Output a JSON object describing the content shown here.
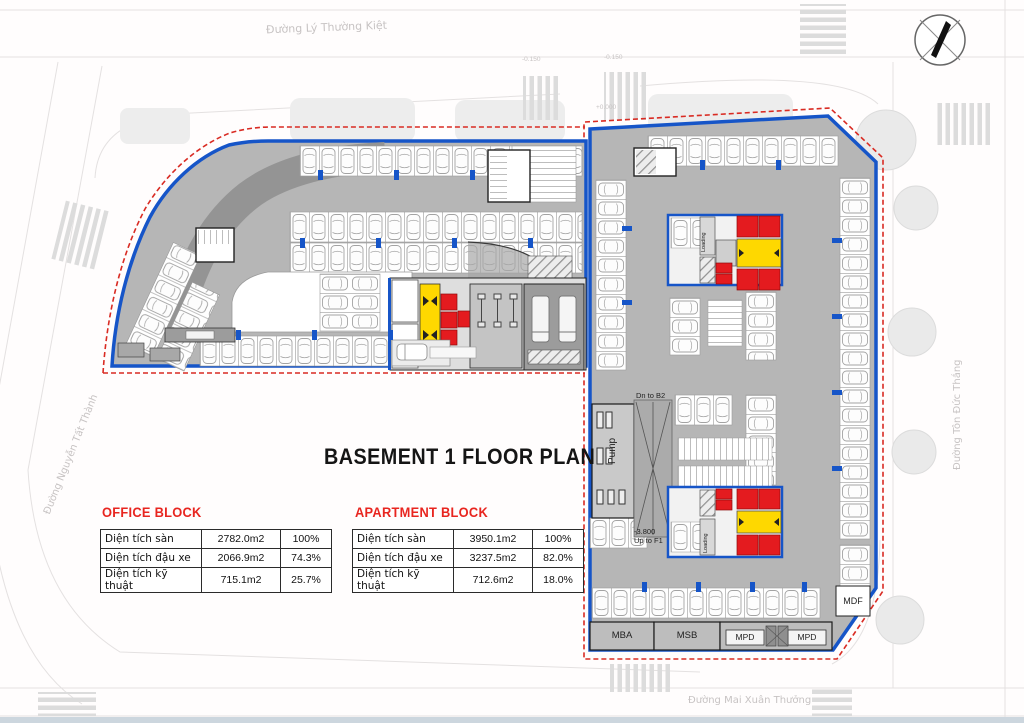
{
  "title": "BASEMENT 1 FLOOR PLAN",
  "tables": {
    "office": {
      "header": "OFFICE BLOCK",
      "rows": [
        {
          "label": "Diện tích sàn",
          "value": "2782.0m2",
          "percent": "100%"
        },
        {
          "label": "Diện tích đậu xe",
          "value": "2066.9m2",
          "percent": "74.3%"
        },
        {
          "label": "Diện tích kỹ thuật",
          "value": "715.1m2",
          "percent": "25.7%"
        }
      ]
    },
    "apartment": {
      "header": "APARTMENT BLOCK",
      "rows": [
        {
          "label": "Diện tích sàn",
          "value": "3950.1m2",
          "percent": "100%"
        },
        {
          "label": "Diện tích đậu xe",
          "value": "3237.5m2",
          "percent": "82.0%"
        },
        {
          "label": "Diện tích kỹ thuật",
          "value": "712.6m2",
          "percent": "18.0%"
        }
      ]
    }
  },
  "streets": {
    "top": "Đường Lý Thường Kiệt",
    "right": "Đường Tôn Đức Thắng",
    "left": "Đường Nguyễn Tất Thành",
    "bottom": "Đường Mai Xuân Thưởng"
  },
  "plan_labels": {
    "pump": "Pump",
    "dn_to_b2": "Dn to B2",
    "ramp_level": "-3.800",
    "ramp_dir": "Up to F1",
    "loading": "Loading",
    "mdf": "MDF",
    "mba": "MBA",
    "msb": "MSB",
    "mpd": "MPD"
  },
  "elevations": [
    "-0.150",
    "-0.150",
    "+0.000"
  ],
  "colors": {
    "boundary_blue": "#1655c8",
    "boundary_red_dash": "#d92b23",
    "core_red": "#e41b1f",
    "lobby_yellow": "#fed800",
    "header_red": "#e8251f",
    "floor_gray": "#b6b6b6"
  },
  "icons": {
    "compass": "north-arrow-compass"
  }
}
